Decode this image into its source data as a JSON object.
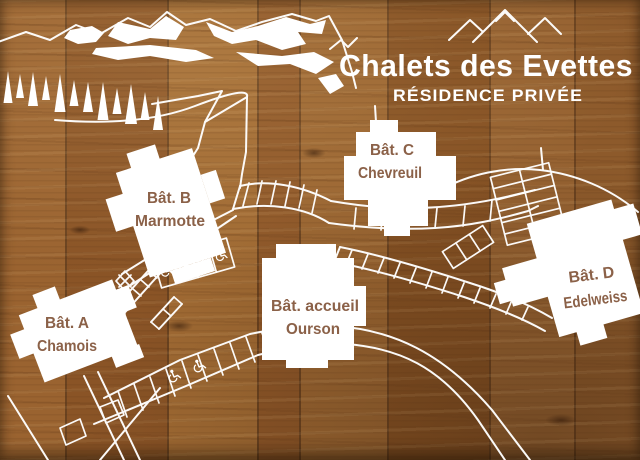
{
  "sign": {
    "title": "Chalets des Evettes",
    "subtitle": "RÉSIDENCE PRIVÉE",
    "logo_icon": "three-mountain-peaks",
    "scene_icons": [
      "mountain-ridge",
      "snow-patches",
      "pine-tree"
    ],
    "map_icons": {
      "accessible_parking": "wheelchair"
    },
    "buildings": [
      {
        "id": "A",
        "line1": "Bât. A",
        "line2": "Chamois"
      },
      {
        "id": "B",
        "line1": "Bât. B",
        "line2": "Marmotte"
      },
      {
        "id": "C",
        "line1": "Bât. C",
        "line2": "Chevreuil"
      },
      {
        "id": "D",
        "line1": "Bât. D",
        "line2": "Edelweiss"
      },
      {
        "id": "accueil",
        "line1": "Bât. accueil",
        "line2": "Ourson"
      }
    ],
    "colors": {
      "line_art": "#ffffff",
      "building_fill": "#ffffff",
      "label_text": "#8b6148",
      "title_text": "#ffffff",
      "wood_base": "#8f5c2c"
    }
  }
}
